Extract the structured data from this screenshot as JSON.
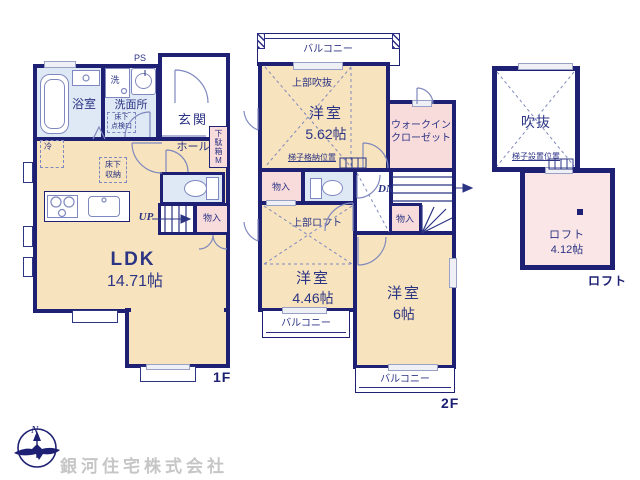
{
  "colors": {
    "wall": "#1e2173",
    "wood_floor": "#f7e3bd",
    "wet_floor": "#dfe9f6",
    "storage_pink": "#f8dcdc",
    "loft_pink": "#fae6e6",
    "label_text": "#2c3484",
    "fixture_line": "#8089bf",
    "window_fill": "#eef0f6",
    "watermark_gray": "#c6c6c6"
  },
  "plan_1f": {
    "tag": "1F",
    "rooms": {
      "bath": "浴室",
      "washer": "洗",
      "ps": "PS",
      "washroom": "洗面所",
      "underfloor_hatch_l1": "床下",
      "underfloor_hatch_l2": "点検口",
      "entrance": "玄関",
      "hall": "ホール",
      "shoe_box": "下駄箱",
      "shoe_box_size": "M",
      "fridge": "冷",
      "underfloor_storage_l1": "床下",
      "underfloor_storage_l2": "収納",
      "stairs_up": "UP",
      "closet": "物入",
      "ldk": "LDK",
      "ldk_size": "14.71帖"
    }
  },
  "plan_2f": {
    "tag": "2F",
    "rooms": {
      "balcony_top": "バルコニー",
      "upper_void": "上部吹抜",
      "bedroom1": "洋室",
      "bedroom1_size": "5.62帖",
      "ladder_storage": "梯子格納位置",
      "wic_l1": "ウォークイン",
      "wic_l2": "クローゼット",
      "closet_a": "物入",
      "stairs_dn": "DN",
      "closet_b": "物入",
      "upper_loft": "上部ロフト",
      "bedroom2": "洋室",
      "bedroom2_size": "4.46帖",
      "balcony_left": "バルコニー",
      "bedroom3": "洋室",
      "bedroom3_size": "6帖",
      "balcony_bottom": "バルコニー"
    }
  },
  "plan_loft": {
    "tag": "ロフト",
    "rooms": {
      "void": "吹抜",
      "ladder_position": "梯子設置位置",
      "loft": "ロフト",
      "loft_size": "4.12帖"
    }
  },
  "footer": {
    "compass_n": "N",
    "company": "銀河住宅株式会社"
  }
}
